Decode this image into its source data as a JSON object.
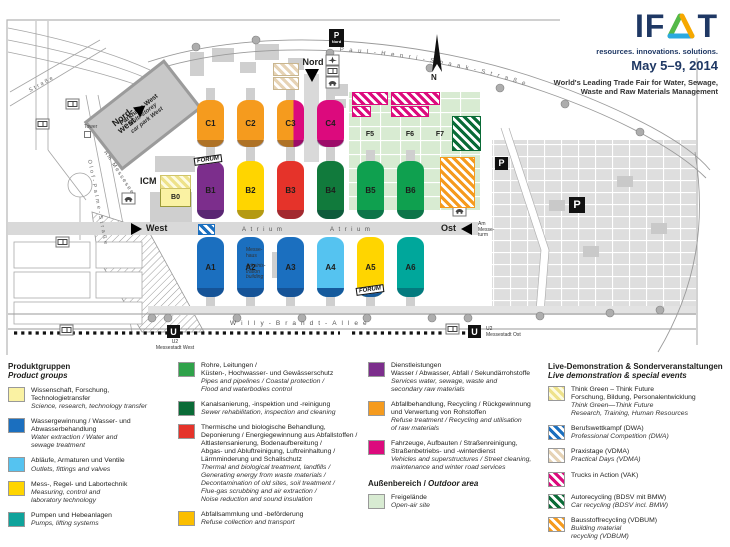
{
  "header": {
    "logo_if": "IF",
    "logo_t": "T",
    "tagline": "resources. innovations. solutions.",
    "dates": "May 5–9, 2014",
    "subtitle": "World's Leading Trade Fair for Water, Sewage,\nWaste and Raw Materials Management"
  },
  "map": {
    "halls": {
      "A1": "A1",
      "A2": "A2",
      "A3": "A3",
      "A4": "A4",
      "A5": "A5",
      "A6": "A6",
      "B0": "B0",
      "B1": "B1",
      "B2": "B2",
      "B3": "B3",
      "B4": "B4",
      "B5": "B5",
      "B6": "B6",
      "C1": "C1",
      "C2": "C2",
      "C3": "C3",
      "C4": "C4",
      "F5": "F5",
      "F6": "F6",
      "F7": "F7"
    },
    "entrances": {
      "nordwest": "Nord-\nwest",
      "nord": "Nord",
      "west": "West",
      "ost": "Ost"
    },
    "labels": {
      "icm": "ICM",
      "tower": "Tower",
      "forum": "FORUM",
      "parkhaus_de": "Parkhaus West",
      "parkhaus_en": "Multi-storey\ncar park West",
      "messehaus": "Messe-\nhaus",
      "admin": "Adminis-\ntration\nbuilding",
      "am_messeturm": "Am\nMesse-\nturm",
      "atrium": "Atrium",
      "p": "P",
      "p_nord": "Nord",
      "u": "U",
      "n": "N",
      "u2_west": "U2\nMessestadt West",
      "u2_ost": "U2\nMessestadt Ost"
    },
    "streets": {
      "willy": "Willy-Brandt-Allee",
      "olof": "Olof-Palme-Straße",
      "paul_henri": "Paul-Henri-Spaak-Straße",
      "am_messesee": "Am Messesee",
      "strasse_nw": "Straße"
    }
  },
  "legend": {
    "product_groups": {
      "title_de": "Produktgruppen",
      "title_en": "Product groups",
      "items": [
        {
          "de": "Wissenschaft, Forschung,\nTechnologietransfer",
          "en": "Science, research, technology transfer"
        },
        {
          "de": "Wassergewinnung / Wasser- und\nAbwasserbehandlung",
          "en": "Water extraction / Water and\nsewage treatment"
        },
        {
          "de": "Abläufe, Armaturen und Ventile",
          "en": "Outlets, fittings and valves"
        },
        {
          "de": "Mess-, Regel- und Labortechnik",
          "en": "Measuring, control and\nlaboratory technology"
        },
        {
          "de": "Pumpen und Hebeanlagen",
          "en": "Pumps, lifting systems"
        }
      ]
    },
    "col2_items": [
      {
        "de": "Rohre, Leitungen /\nKüsten-, Hochwasser- und Gewässerschutz",
        "en": "Pipes and pipelines / Coastal protection /\nFlood and waterbodies control"
      },
      {
        "de": "Kanalsanierung, -inspektion und -reinigung",
        "en": "Sewer rehabilitation, inspection and cleaning"
      },
      {
        "de": "Thermische und biologische Behandlung,\nDeponierung / Energiegewinnung aus Abfallstoffen /\nAltlastensanierung, Bodenaufbereitung /\nAbgas- und Abluftreinigung, Luftreinhaltung /\nLärmminderung und Schallschutz",
        "en": "Thermal and biological treatment, landfills /\nGenerating energy from waste materials /\nDecontamination of old sites, soil treatment /\nFlue-gas scrubbing and air extraction /\nNoise reduction and sound insulation"
      },
      {
        "de": "Abfallsammlung und -beförderung",
        "en": "Refuse collection and transport"
      }
    ],
    "col3": {
      "items": [
        {
          "de": "Dienstleistungen\nWasser / Abwasser, Abfall / Sekundärrohstoffe",
          "en": "Services water, sewage, waste and\nsecondary raw materials"
        },
        {
          "de": "Abfallbehandlung, Recycling / Rückgewinnung\nund Verwertung von Rohstoffen",
          "en": "Refuse treatment / Recycling and utilisation\nof raw materials"
        },
        {
          "de": "Fahrzeuge, Aufbauten / Straßenreinigung,\nStraßenbetriebs- und -winterdienst",
          "en": "Vehicles and superstructures / Street cleaning,\nmaintenance and winter road services"
        }
      ],
      "outdoor_de": "Außenbereich /",
      "outdoor_en": "Outdoor area",
      "outdoor_item": {
        "de": "Freigelände",
        "en": "Open-air site"
      }
    },
    "live": {
      "title_de": "Live-Demonstration & Sonderveranstaltungen",
      "title_en": "Live demonstration & special events",
      "items": [
        {
          "de": "Think Green – Think Future\nForschung, Bildung, Personalentwicklung",
          "en": "Think Green—Think Future\nResearch, Training, Human Resources"
        },
        {
          "de": "Berufswettkampf (DWA)",
          "en": "Professional Competition (DWA)"
        },
        {
          "de": "Praxistage (VDMA)",
          "en": "Practical Days (VDMA)"
        },
        {
          "de": "Trucks in Action (VAK)",
          "en": ""
        },
        {
          "de": "Autorecycling (BDSV mit BMW)",
          "en": "Car recycling (BDSV incl. BMW)"
        },
        {
          "de": "Bausstoffrecycling (VDBUM)",
          "en": "Building material\nrecycling (VDBUM)"
        }
      ]
    }
  },
  "colors": {
    "orange": "#F59B1E",
    "magenta": "#DC0A7D",
    "purple": "#7C2E8C",
    "yellow": "#FFD500",
    "red": "#E5332A",
    "dark_green": "#117A3C",
    "green": "#0FA04F",
    "blue": "#1B6FBF",
    "light_blue": "#55C3F0",
    "teal": "#00A79B",
    "pale_yellow": "#FAF2A3",
    "open_air": "#D8EBD2",
    "logo_navy": "#1F3864"
  }
}
